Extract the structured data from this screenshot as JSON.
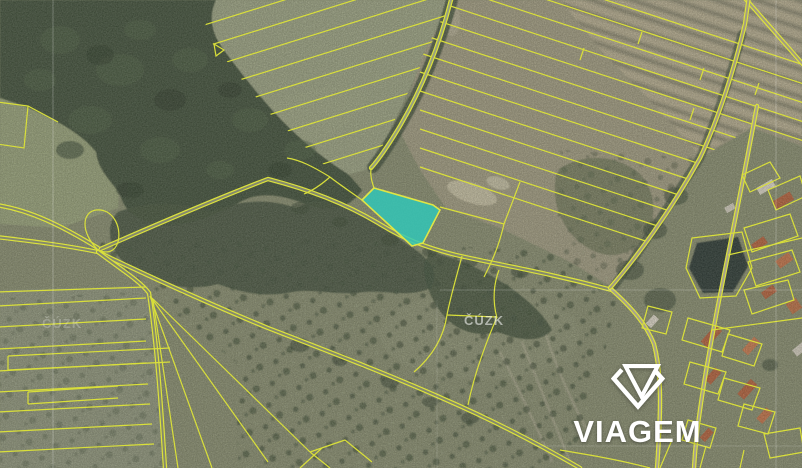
{
  "map": {
    "provider_watermark": "ČÚZK",
    "provider_watermark_faint": "ČÚZK",
    "highlight_color": "#2fc8ba",
    "parcel_line_color": "#dce23c"
  },
  "branding": {
    "logo_text": "VIAGEM",
    "logo_icon": "viagem-gem-icon",
    "logo_color": "#ffffff"
  }
}
